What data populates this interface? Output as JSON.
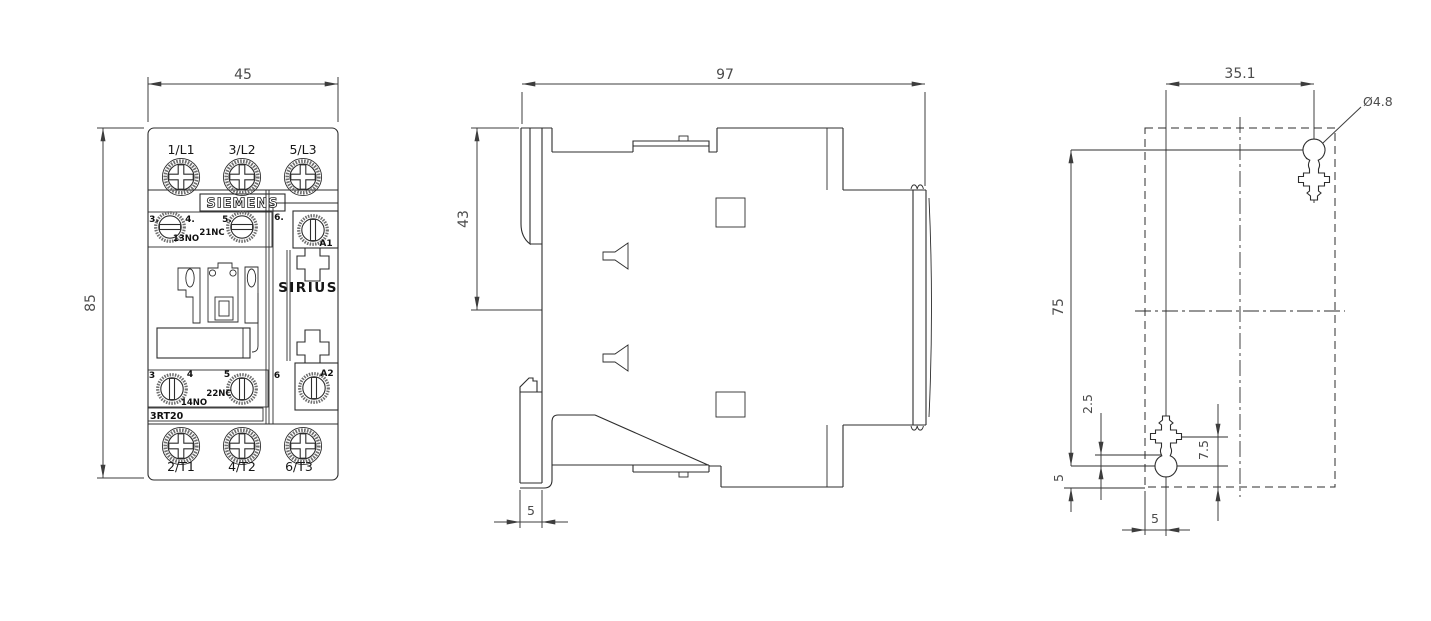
{
  "front": {
    "dim_width": "45",
    "dim_height": "85",
    "brand": "SIEMENS",
    "series": "SIRIUS",
    "model": "3RT20",
    "top_terminals": {
      "t1": "1/L1",
      "t2": "3/L2",
      "t3": "5/L3"
    },
    "bottom_terminals": {
      "t1": "2/T1",
      "t2": "4/T2",
      "t3": "6/T3"
    },
    "aux_upper": {
      "n3": "3.",
      "n4": "4.",
      "n5": "5.",
      "n6": "6.",
      "no": "13NO",
      "nc": "21NC",
      "coil": "A1"
    },
    "aux_lower": {
      "n3": "3",
      "n4": "4",
      "n5": "5",
      "n6": "6",
      "nc": "22NC",
      "no": "14NO",
      "coil": "A2"
    }
  },
  "side": {
    "dim_depth": "97",
    "dim_upper": "43",
    "dim_foot": "5"
  },
  "plan": {
    "dim_spacing": "35.1",
    "dim_hole": "Ø4.8",
    "dim_height": "75",
    "dim_offset_a": "2.5",
    "dim_offset_b": "7.5",
    "dim_edge_left": "5",
    "dim_edge_bottom": "5"
  },
  "colors": {
    "line": "#2d2d2d",
    "dimension_text": "#4c4c4c",
    "knurl": "#6f6f6f",
    "background": "#ffffff"
  }
}
